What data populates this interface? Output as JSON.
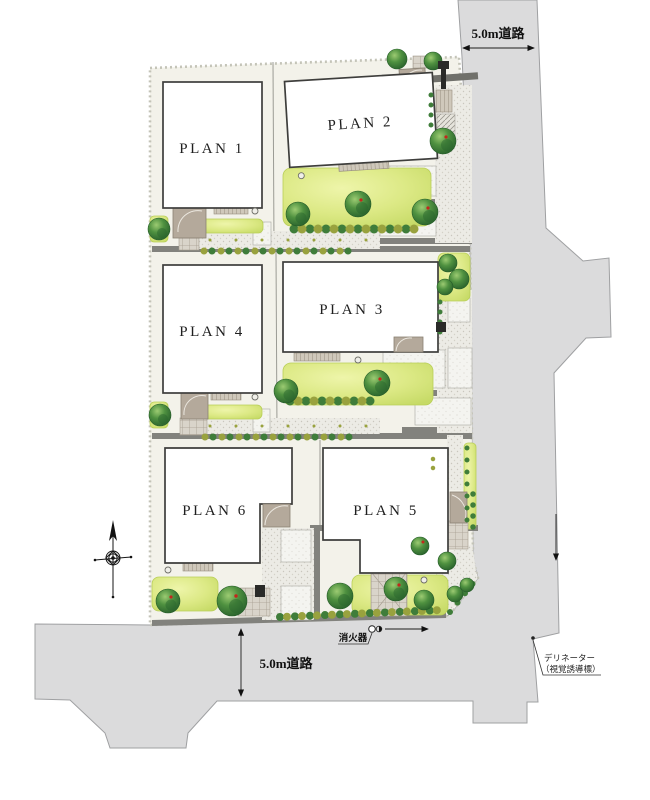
{
  "plots": [
    {
      "label": "PLAN 1"
    },
    {
      "label": "PLAN 2"
    },
    {
      "label": "PLAN 3"
    },
    {
      "label": "PLAN 4"
    },
    {
      "label": "PLAN 5"
    },
    {
      "label": "PLAN 6"
    }
  ],
  "roads": {
    "top": "5.0m道路",
    "bottom": "5.0m道路"
  },
  "annotations": {
    "fire_extinguisher": "消火器",
    "delineator": [
      "デリネーター",
      "（視覚誘導標）"
    ]
  },
  "icons": {
    "compass": "compass-rose",
    "fire_extinguisher": "circle-marker-with-flag",
    "delineator": "dot-marker",
    "road_width": "double-headed-arrow"
  },
  "colors": {
    "road": "#dbdbdc",
    "site": "#f3f2ea",
    "building": "#ffffff",
    "grass": "#d9e77e",
    "tree": "#3b7c38",
    "shrub_olive": "#99a23e",
    "separator": "#82827d",
    "accent_red": "#c4271c"
  }
}
